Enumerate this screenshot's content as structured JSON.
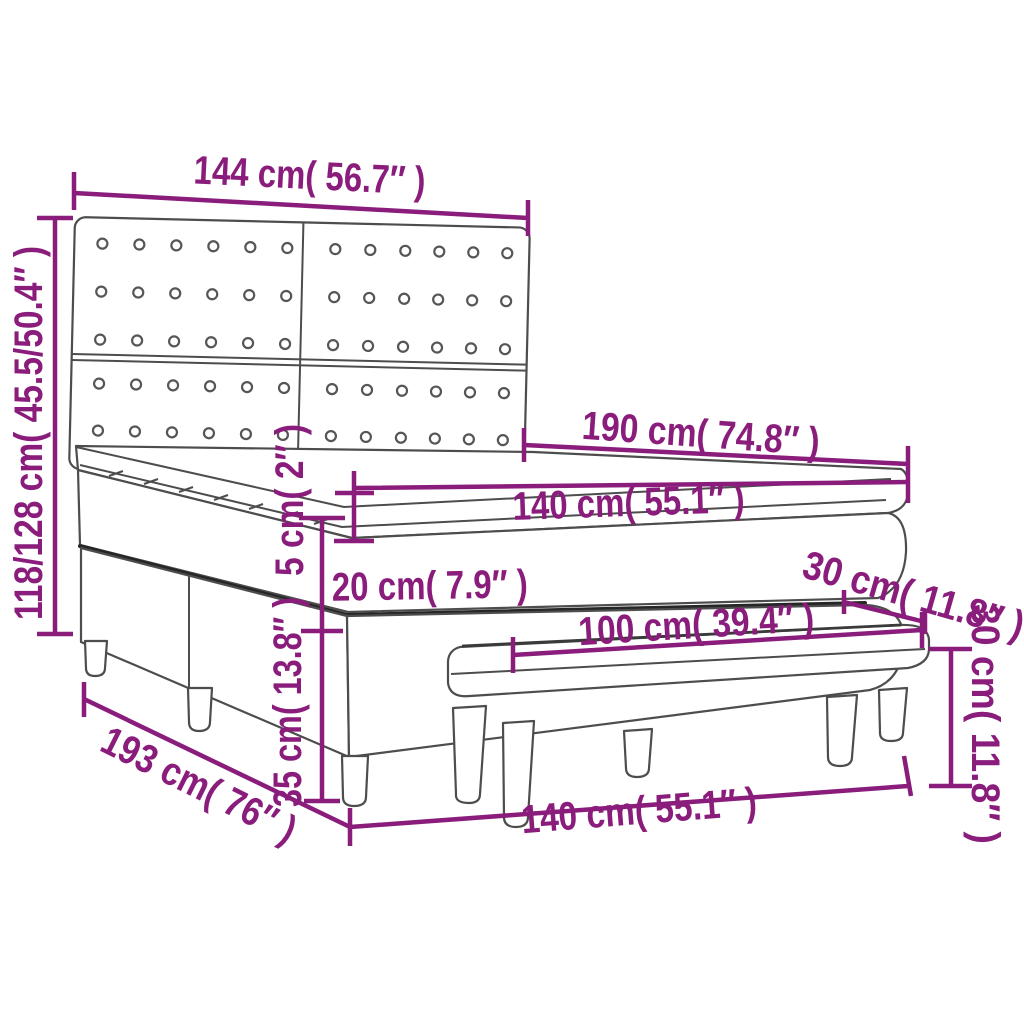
{
  "title": "Box spring bed with tufted headboard and bench — dimension diagram",
  "accent_color": "#8a1d7c",
  "line_color": "#4d4d4d",
  "background_color": "#ffffff",
  "diagram": {
    "dimensions": [
      {
        "name": "headboard-width",
        "label": "144 cm( 56.7″ )"
      },
      {
        "name": "bed-height-range",
        "label": "118/128 cm( 45.5/50.4″ )"
      },
      {
        "name": "mattress-length",
        "label": "190 cm( 74.8″ )"
      },
      {
        "name": "mattress-width",
        "label": "140 cm( 55.1″ )"
      },
      {
        "name": "topper-thickness",
        "label": "5 cm( 2″ )"
      },
      {
        "name": "mattress-thickness",
        "label": "20 cm( 7.9″ )"
      },
      {
        "name": "foot-rail-depth",
        "label": "30 cm( 11.8″ )"
      },
      {
        "name": "bench-length",
        "label": "100 cm( 39.4″ )"
      },
      {
        "name": "base-height",
        "label": "35 cm( 13.8″ )"
      },
      {
        "name": "bed-length",
        "label": "193 cm( 76″ )"
      },
      {
        "name": "bed-width",
        "label": "140 cm( 55.1″ )"
      },
      {
        "name": "bench-height",
        "label": "30 cm( 11.8″ )"
      }
    ]
  }
}
